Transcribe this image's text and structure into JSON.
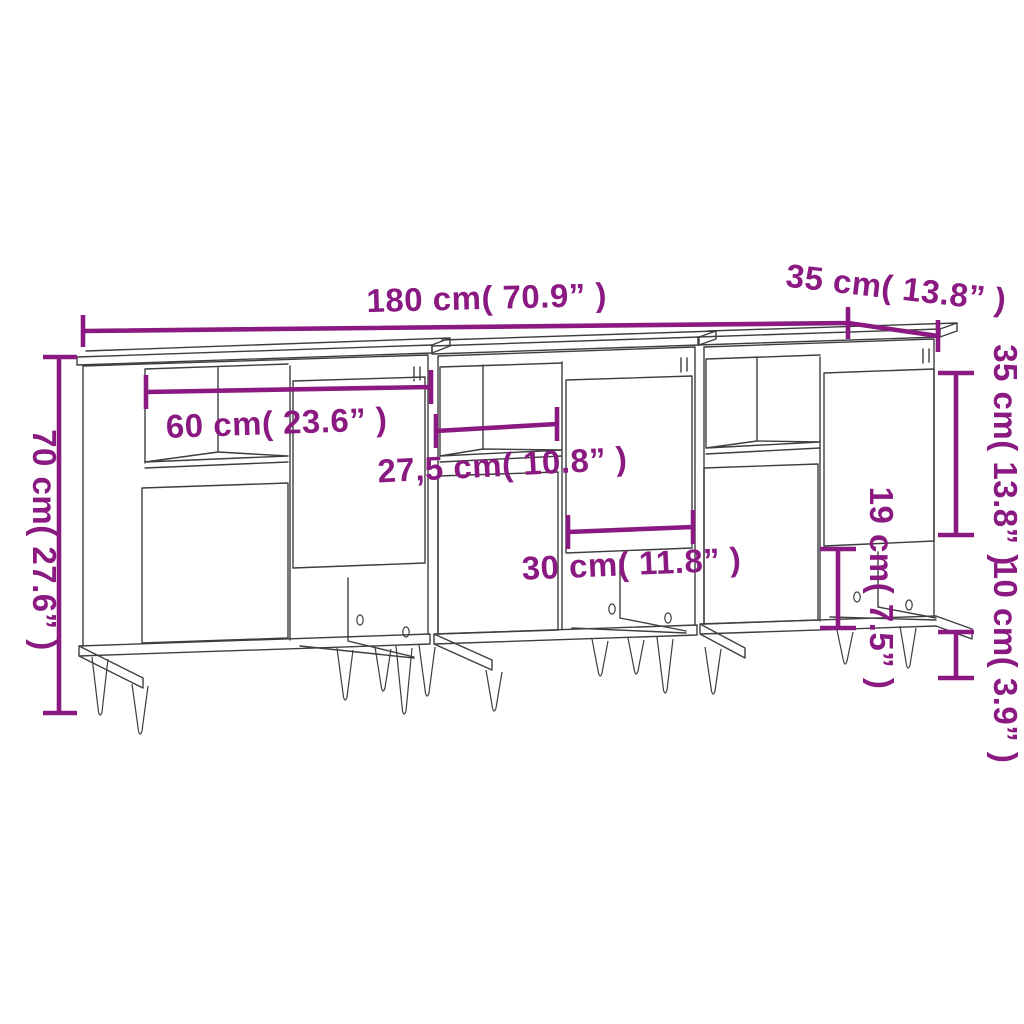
{
  "colors": {
    "background": "#ffffff",
    "dimension": "#8a1a82",
    "outline": "#3e3e3e"
  },
  "labels": {
    "width": "180 cm( 70.9” )",
    "depth": "35 cm( 13.8” )",
    "height": "70 cm( 27.6” )",
    "inner_width": "60 cm( 23.6” )",
    "shelf_width": "27,5 cm( 10.8” )",
    "compartment_width": "30 cm( 11.8” )",
    "upper_door_height": "35 cm( 13.8” )",
    "compartment_height": "19 cm( 7.5” )",
    "leg_height": "10 cm( 3.9” )"
  }
}
